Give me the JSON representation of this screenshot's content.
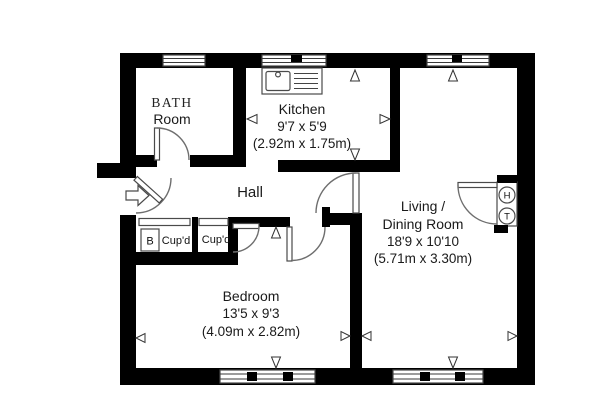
{
  "colors": {
    "wall": "#000000",
    "background": "#ffffff",
    "thin_line": "#4a4a4a"
  },
  "rooms": {
    "bathroom": {
      "label_line1": "BATH",
      "label_line2": "Room"
    },
    "kitchen": {
      "label": "Kitchen",
      "size_imperial": "9'7 x 5'9",
      "size_metric": "(2.92m x 1.75m)"
    },
    "hall": {
      "label": "Hall"
    },
    "living_dining": {
      "label_line1": "Living /",
      "label_line2": "Dining Room",
      "size_imperial": "18'9 x 10'10",
      "size_metric": "(5.71m x 3.30m)"
    },
    "bedroom": {
      "label": "Bedroom",
      "size_imperial": "13'5 x 9'3",
      "size_metric": "(4.09m x 2.82m)"
    },
    "cupboard_1": {
      "label": "Cup'd"
    },
    "cupboard_2": {
      "label": "Cup'd"
    },
    "boiler": {
      "label": "B"
    },
    "cylinder_h": {
      "label": "H"
    },
    "cylinder_t": {
      "label": "T"
    }
  }
}
